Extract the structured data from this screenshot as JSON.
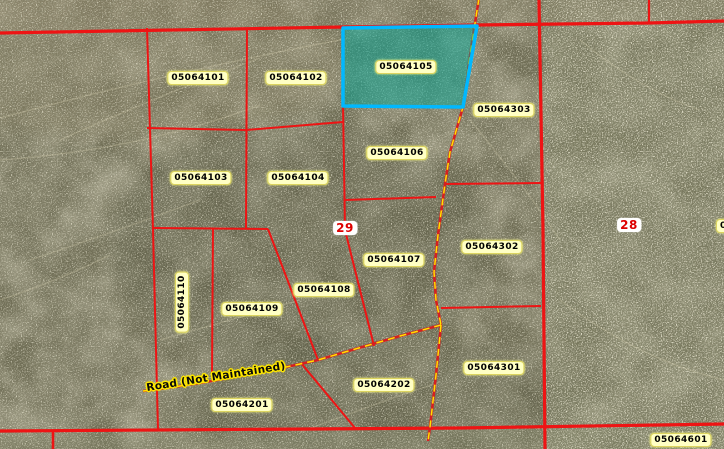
{
  "map": {
    "description_title": "Parcel map with aerial imagery",
    "selected_parcel": "05064105",
    "road_name": "Road (Not Maintained)",
    "section_numbers": [
      "29",
      "28"
    ],
    "parcel_numbers": [
      "05064101",
      "05064102",
      "05064105",
      "05064303",
      "05064103",
      "05064104",
      "05064106",
      "05064302",
      "05064107",
      "05064108",
      "05064109",
      "05064110",
      "05064301",
      "05064202",
      "05064201",
      "05064601"
    ],
    "labels": [
      {
        "name": "parcel-label-05064101",
        "text": "05064101",
        "x": 198,
        "y": 78,
        "type": "parcel"
      },
      {
        "name": "parcel-label-05064102",
        "text": "05064102",
        "x": 296,
        "y": 78,
        "type": "parcel"
      },
      {
        "name": "parcel-label-05064105",
        "text": "05064105",
        "x": 406,
        "y": 67,
        "type": "parcel"
      },
      {
        "name": "parcel-label-05064303",
        "text": "05064303",
        "x": 504,
        "y": 110,
        "type": "parcel"
      },
      {
        "name": "parcel-label-05064103",
        "text": "05064103",
        "x": 201,
        "y": 178,
        "type": "parcel"
      },
      {
        "name": "parcel-label-05064104",
        "text": "05064104",
        "x": 298,
        "y": 178,
        "type": "parcel"
      },
      {
        "name": "parcel-label-05064106",
        "text": "05064106",
        "x": 397,
        "y": 153,
        "type": "parcel"
      },
      {
        "name": "parcel-label-05064302",
        "text": "05064302",
        "x": 492,
        "y": 247,
        "type": "parcel"
      },
      {
        "name": "parcel-label-05064107",
        "text": "05064107",
        "x": 394,
        "y": 260,
        "type": "parcel"
      },
      {
        "name": "parcel-label-05064108",
        "text": "05064108",
        "x": 324,
        "y": 290,
        "type": "parcel"
      },
      {
        "name": "parcel-label-05064109",
        "text": "05064109",
        "x": 252,
        "y": 309,
        "type": "parcel"
      },
      {
        "name": "parcel-label-05064110",
        "text": "05064110",
        "x": 182,
        "y": 302,
        "type": "parcel",
        "rotation": -90
      },
      {
        "name": "parcel-label-05064301",
        "text": "05064301",
        "x": 494,
        "y": 368,
        "type": "parcel"
      },
      {
        "name": "parcel-label-05064202",
        "text": "05064202",
        "x": 384,
        "y": 385,
        "type": "parcel"
      },
      {
        "name": "parcel-label-05064201",
        "text": "05064201",
        "x": 242,
        "y": 405,
        "type": "parcel"
      },
      {
        "name": "parcel-label-05064601",
        "text": "05064601",
        "x": 681,
        "y": 440,
        "type": "parcel"
      },
      {
        "name": "parcel-label-partial-right-edge",
        "text": "0",
        "x": 716,
        "y": 226,
        "type": "parcel-partial"
      },
      {
        "name": "section-label-29",
        "text": "29",
        "x": 345,
        "y": 228,
        "type": "section"
      },
      {
        "name": "section-label-28",
        "text": "629-28",
        "x": 629,
        "y": 225,
        "type": "section"
      },
      {
        "name": "road-label",
        "text": "Road (Not Maintained)",
        "x": 216,
        "y": 377,
        "type": "road",
        "rotation": -9
      }
    ],
    "colors": {
      "selection_border": "#00b8ff",
      "selection_fill": "rgba(0,165,150,0.5)",
      "parcel_line": "#ee1414",
      "road_dash": "#ffe400",
      "label_background": "#ffffc4",
      "section_number_text": "#dd0000"
    }
  }
}
